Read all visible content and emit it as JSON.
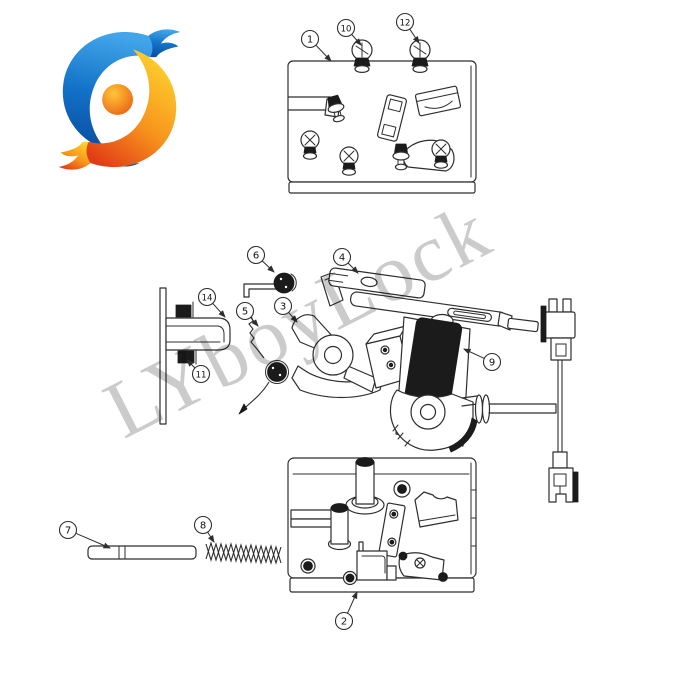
{
  "watermark": {
    "text": "LYboyLock"
  },
  "logo": {
    "name": "lyboy-swirl-logo"
  },
  "colors": {
    "line": "#2e2e2e",
    "dark": "#1b1b1b",
    "watermark": "rgba(118,118,118,0.38)",
    "logo_blue_light": "#42a5e9",
    "logo_blue": "#1272c8",
    "logo_blue_dark": "#0a4da0",
    "logo_yellow": "#ffd42e",
    "logo_orange": "#f7941d",
    "logo_red": "#e23b17",
    "logo_ball": "#e85a0d",
    "logo_ball_light": "#ffc53a"
  },
  "callouts": [
    {
      "label": "1",
      "cx": 310,
      "cy": 39,
      "tx": 331,
      "ty": 61
    },
    {
      "label": "10",
      "cx": 346,
      "cy": 28,
      "tx": 361,
      "ty": 45
    },
    {
      "label": "12",
      "cx": 405,
      "cy": 22,
      "tx": 419,
      "ty": 43
    },
    {
      "label": "14",
      "cx": 207,
      "cy": 297,
      "tx": 225,
      "ty": 317
    },
    {
      "label": "11",
      "cx": 201,
      "cy": 374,
      "tx": 187,
      "ty": 360
    },
    {
      "label": "6",
      "cx": 256,
      "cy": 255,
      "tx": 274,
      "ty": 272
    },
    {
      "label": "5",
      "cx": 245,
      "cy": 311,
      "tx": 258,
      "ty": 326
    },
    {
      "label": "3",
      "cx": 283,
      "cy": 306,
      "tx": 297,
      "ty": 322
    },
    {
      "label": "4",
      "cx": 342,
      "cy": 257,
      "tx": 358,
      "ty": 273
    },
    {
      "label": "9",
      "cx": 492,
      "cy": 362,
      "tx": 464,
      "ty": 349
    },
    {
      "label": "7",
      "cx": 68,
      "cy": 530,
      "tx": 110,
      "ty": 548
    },
    {
      "label": "8",
      "cx": 203,
      "cy": 525,
      "tx": 214,
      "ty": 542
    },
    {
      "label": "2",
      "cx": 344,
      "cy": 621,
      "tx": 357,
      "ty": 592
    }
  ]
}
